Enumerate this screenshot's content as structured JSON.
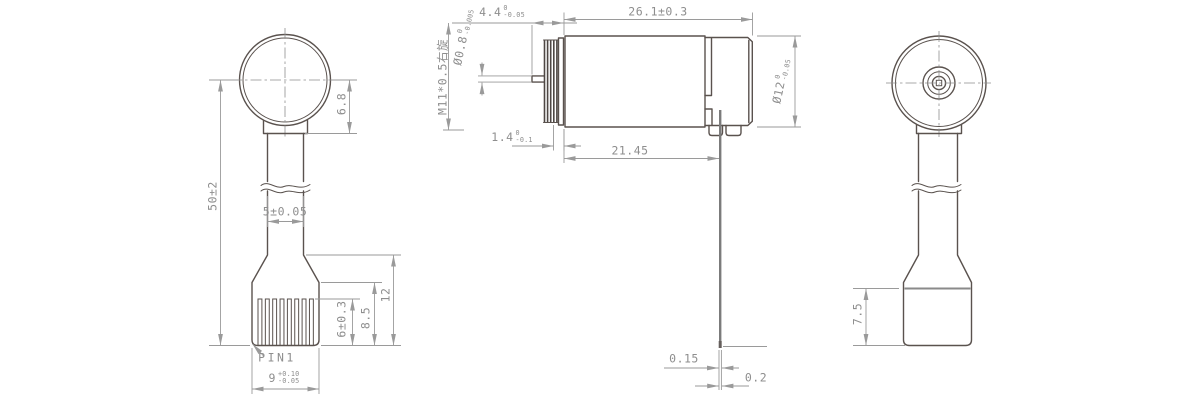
{
  "colors": {
    "background": "#ffffff",
    "object_line": "#5a524e",
    "dimension_line": "#9a9a9a",
    "text": "#8e8e8e",
    "lead_wire": "#7b7b7b"
  },
  "labels": {
    "left_view": {
      "overall_height": "50±2",
      "head_offset": "6.8",
      "stem_width": "5±0.05",
      "pin_strip_height": "6±0.3",
      "pad_height": "8.5",
      "connector_height": "12",
      "pin_marker": "PIN1",
      "connector_width": {
        "main": "9",
        "sup": "+0.10",
        "sub": "-0.05"
      }
    },
    "center_view": {
      "tip_length": {
        "main": "4.4",
        "sup": "0",
        "sub": "-0.05"
      },
      "body_length": "26.1±0.3",
      "thread_spec": "M11*0.5右旋",
      "shaft_diameter": {
        "main": "Ø0.8",
        "sup": "0",
        "sub": "-0.005"
      },
      "collar_length": {
        "main": "1.4",
        "sup": "0",
        "sub": "-0.1"
      },
      "face_to_pin": "21.45",
      "body_diameter": {
        "main": "Ø12",
        "sup": "0",
        "sub": "-0.05"
      },
      "pin_thickness": "0.15",
      "pin_offset": "0.2"
    },
    "right_view": {
      "base_depth": "7.5"
    }
  }
}
